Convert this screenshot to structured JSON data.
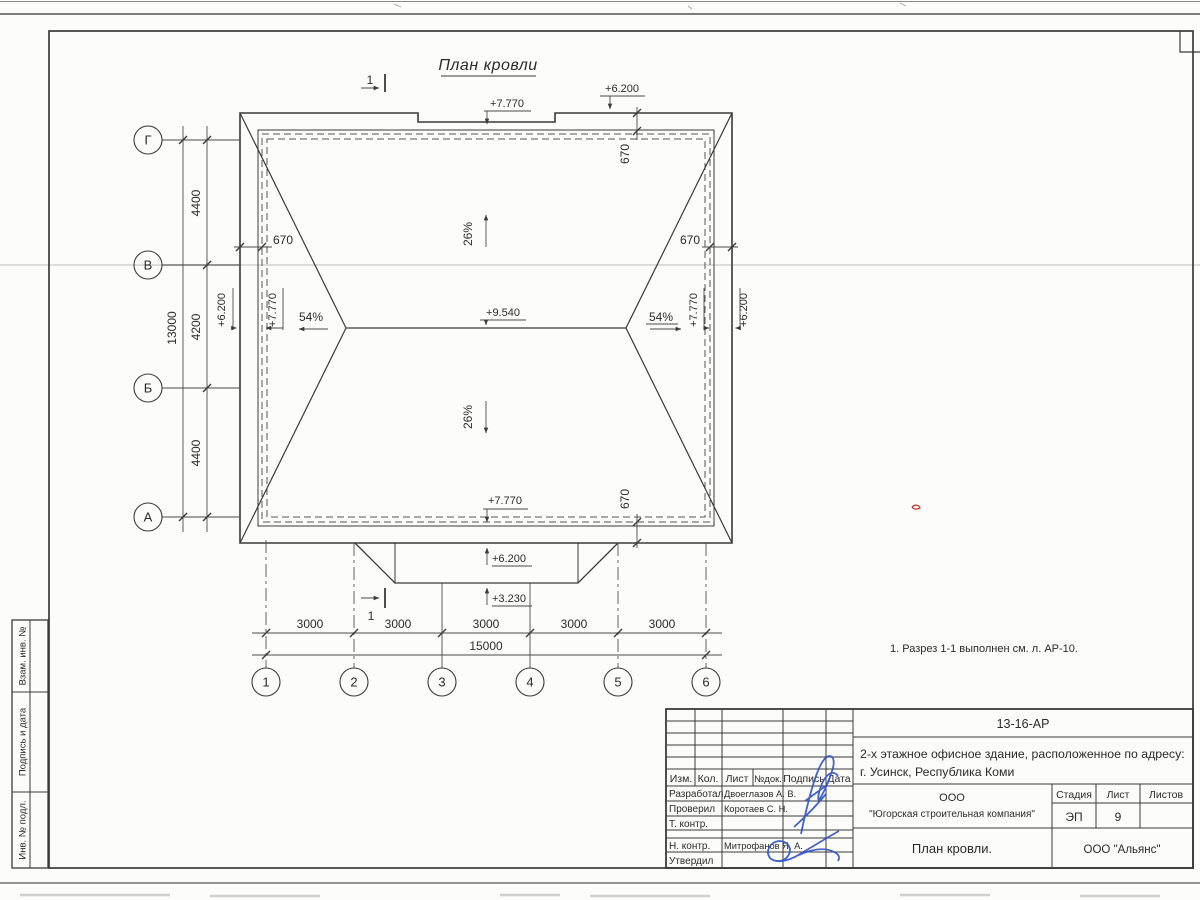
{
  "page": {
    "title": "План кровли"
  },
  "plan": {
    "axes_rows": [
      "Г",
      "В",
      "Б",
      "А"
    ],
    "axes_cols": [
      "1",
      "2",
      "3",
      "4",
      "5",
      "6"
    ],
    "dim_13000": "13000",
    "dim_4400": "4400",
    "dim_4200": "4200",
    "dim_670": "670",
    "dim_3000": "3000",
    "dim_15000": "15000",
    "elev_9540": "+9.540",
    "elev_7770": "+7.770",
    "elev_6200": "+6.200",
    "elev_3230": "+3.230",
    "slope_26": "26%",
    "slope_54": "54%",
    "section_label": "1"
  },
  "note": {
    "text": "1. Разрез 1-1 выполнен см. л. АР-10."
  },
  "stamp": {
    "doc_number": "13-16-АР",
    "object_line1": "2-х этажное офисное здание, расположенное по адресу:",
    "object_line2": "г. Усинск, Республика Коми",
    "org_line1": "ООО",
    "org_line2": "\"Югорская строительная компания\"",
    "sheet_title": "План кровли.",
    "contractor": "ООО \"Альянс\"",
    "stage_label": "Стадия",
    "sheet_label": "Лист",
    "sheets_label": "Листов",
    "stage_value": "ЭП",
    "sheet_value": "9",
    "cols": {
      "izm": "Изм.",
      "kol": "Кол.",
      "list": "Лист",
      "ndoc": "№док.",
      "sign": "Подпись",
      "date": "Дата"
    },
    "rows": {
      "r1_role": "Разработал",
      "r1_name": "Двоеглазов А. В.",
      "r2_role": "Проверил",
      "r2_name": "Коротаев С. Н.",
      "r3_role": "Т. контр.",
      "r4_role": "Н. контр.",
      "r4_name": "Митрофанов Я. А.",
      "r5_role": "Утвердил"
    }
  },
  "side_strip": {
    "box1": "Взам. инв. №",
    "box2": "Подпись и дата",
    "box3": "Инв. № подл."
  },
  "colors": {
    "ink": "#3a3a3a",
    "signature_blue": "#2f52c5",
    "artifact_red": "#c04034"
  }
}
